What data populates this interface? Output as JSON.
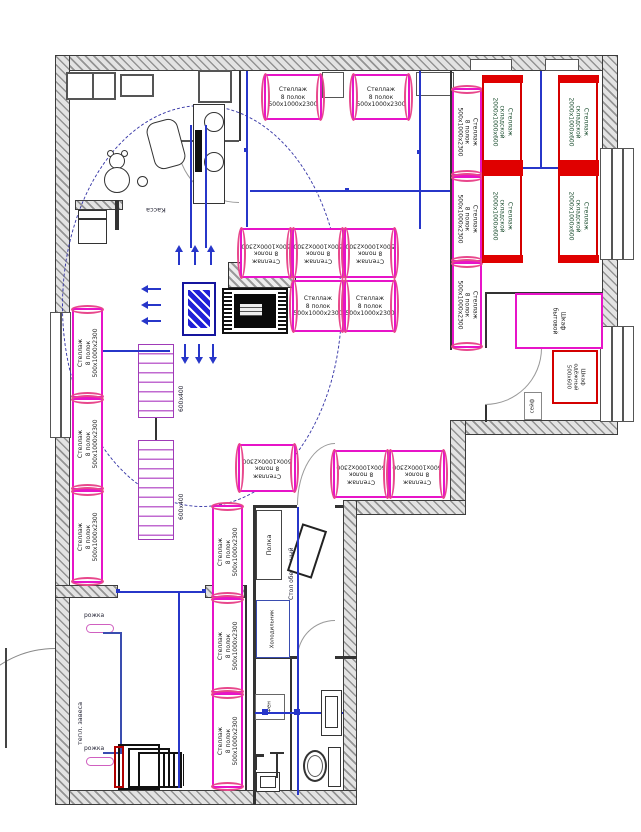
{
  "plan": {
    "labels": {
      "shelf8_l1": "Стеллаж",
      "shelf8_l2": "8 полок",
      "shelf8_l3": "500x1000x2300",
      "storage_l1": "Стеллаж",
      "storage_l2": "складской",
      "storage_l3": "2000x1000x600",
      "rack_label": "600x400",
      "kassa": "Касса",
      "polka": "Полка",
      "dining_table": "Стол обеденный",
      "fridge": "Холодильник",
      "hair_dryer": "Фен",
      "hook": "рожка",
      "thermal_curtain": "тепл. завеса",
      "safe": "сейф",
      "cabinet_small_l1": "Шкаф",
      "cabinet_small_l2": "бытовой",
      "wardrobe_l1": "Шкаф",
      "wardrobe_l2": "одёжный",
      "wardrobe_l3": "500x600"
    },
    "colors": {
      "shelf_magenta": "#e714c8",
      "shelf_cap_pink": "#e8488c",
      "storage_red": "#d40000",
      "dimension_blue": "#2736c9",
      "wall_gray": "#e3e3e3",
      "dashed_circle_navy": "#3a3aa8"
    },
    "shelf_units_8": [
      {
        "x": 264,
        "y": 74,
        "w": 58,
        "h": 46,
        "rot": 0,
        "o": "h"
      },
      {
        "x": 352,
        "y": 74,
        "w": 58,
        "h": 46,
        "rot": 0,
        "o": "h"
      },
      {
        "x": 452,
        "y": 88,
        "w": 30,
        "h": 88,
        "rot": 90,
        "o": "v"
      },
      {
        "x": 452,
        "y": 176,
        "w": 30,
        "h": 86,
        "rot": 90,
        "o": "v"
      },
      {
        "x": 452,
        "y": 262,
        "w": 30,
        "h": 86,
        "rot": 90,
        "o": "v"
      },
      {
        "x": 240,
        "y": 228,
        "w": 52,
        "h": 50,
        "rot": 180,
        "o": "h"
      },
      {
        "x": 292,
        "y": 228,
        "w": 52,
        "h": 50,
        "rot": 180,
        "o": "h"
      },
      {
        "x": 344,
        "y": 228,
        "w": 52,
        "h": 50,
        "rot": 180,
        "o": "h"
      },
      {
        "x": 292,
        "y": 280,
        "w": 52,
        "h": 52,
        "rot": 0,
        "o": "h"
      },
      {
        "x": 344,
        "y": 280,
        "w": 52,
        "h": 52,
        "rot": 0,
        "o": "h"
      },
      {
        "x": 238,
        "y": 444,
        "w": 58,
        "h": 48,
        "rot": 180,
        "o": "h"
      },
      {
        "x": 333,
        "y": 450,
        "w": 56,
        "h": 48,
        "rot": 180,
        "o": "h"
      },
      {
        "x": 389,
        "y": 450,
        "w": 56,
        "h": 48,
        "rot": 180,
        "o": "h"
      },
      {
        "x": 212,
        "y": 505,
        "w": 31,
        "h": 93,
        "rot": -90,
        "o": "v"
      },
      {
        "x": 212,
        "y": 598,
        "w": 31,
        "h": 95,
        "rot": -90,
        "o": "v"
      },
      {
        "x": 212,
        "y": 693,
        "w": 31,
        "h": 95,
        "rot": -90,
        "o": "v"
      },
      {
        "x": 72,
        "y": 308,
        "w": 31,
        "h": 90,
        "rot": -90,
        "o": "v"
      },
      {
        "x": 72,
        "y": 398,
        "w": 31,
        "h": 92,
        "rot": -90,
        "o": "v"
      },
      {
        "x": 72,
        "y": 490,
        "w": 31,
        "h": 93,
        "rot": -90,
        "o": "v"
      }
    ],
    "storage_units": [
      {
        "x": 482,
        "y": 75,
        "w": 40,
        "h": 93
      },
      {
        "x": 482,
        "y": 168,
        "w": 40,
        "h": 95
      },
      {
        "x": 558,
        "y": 75,
        "w": 40,
        "h": 93
      },
      {
        "x": 558,
        "y": 168,
        "w": 40,
        "h": 95
      }
    ]
  }
}
